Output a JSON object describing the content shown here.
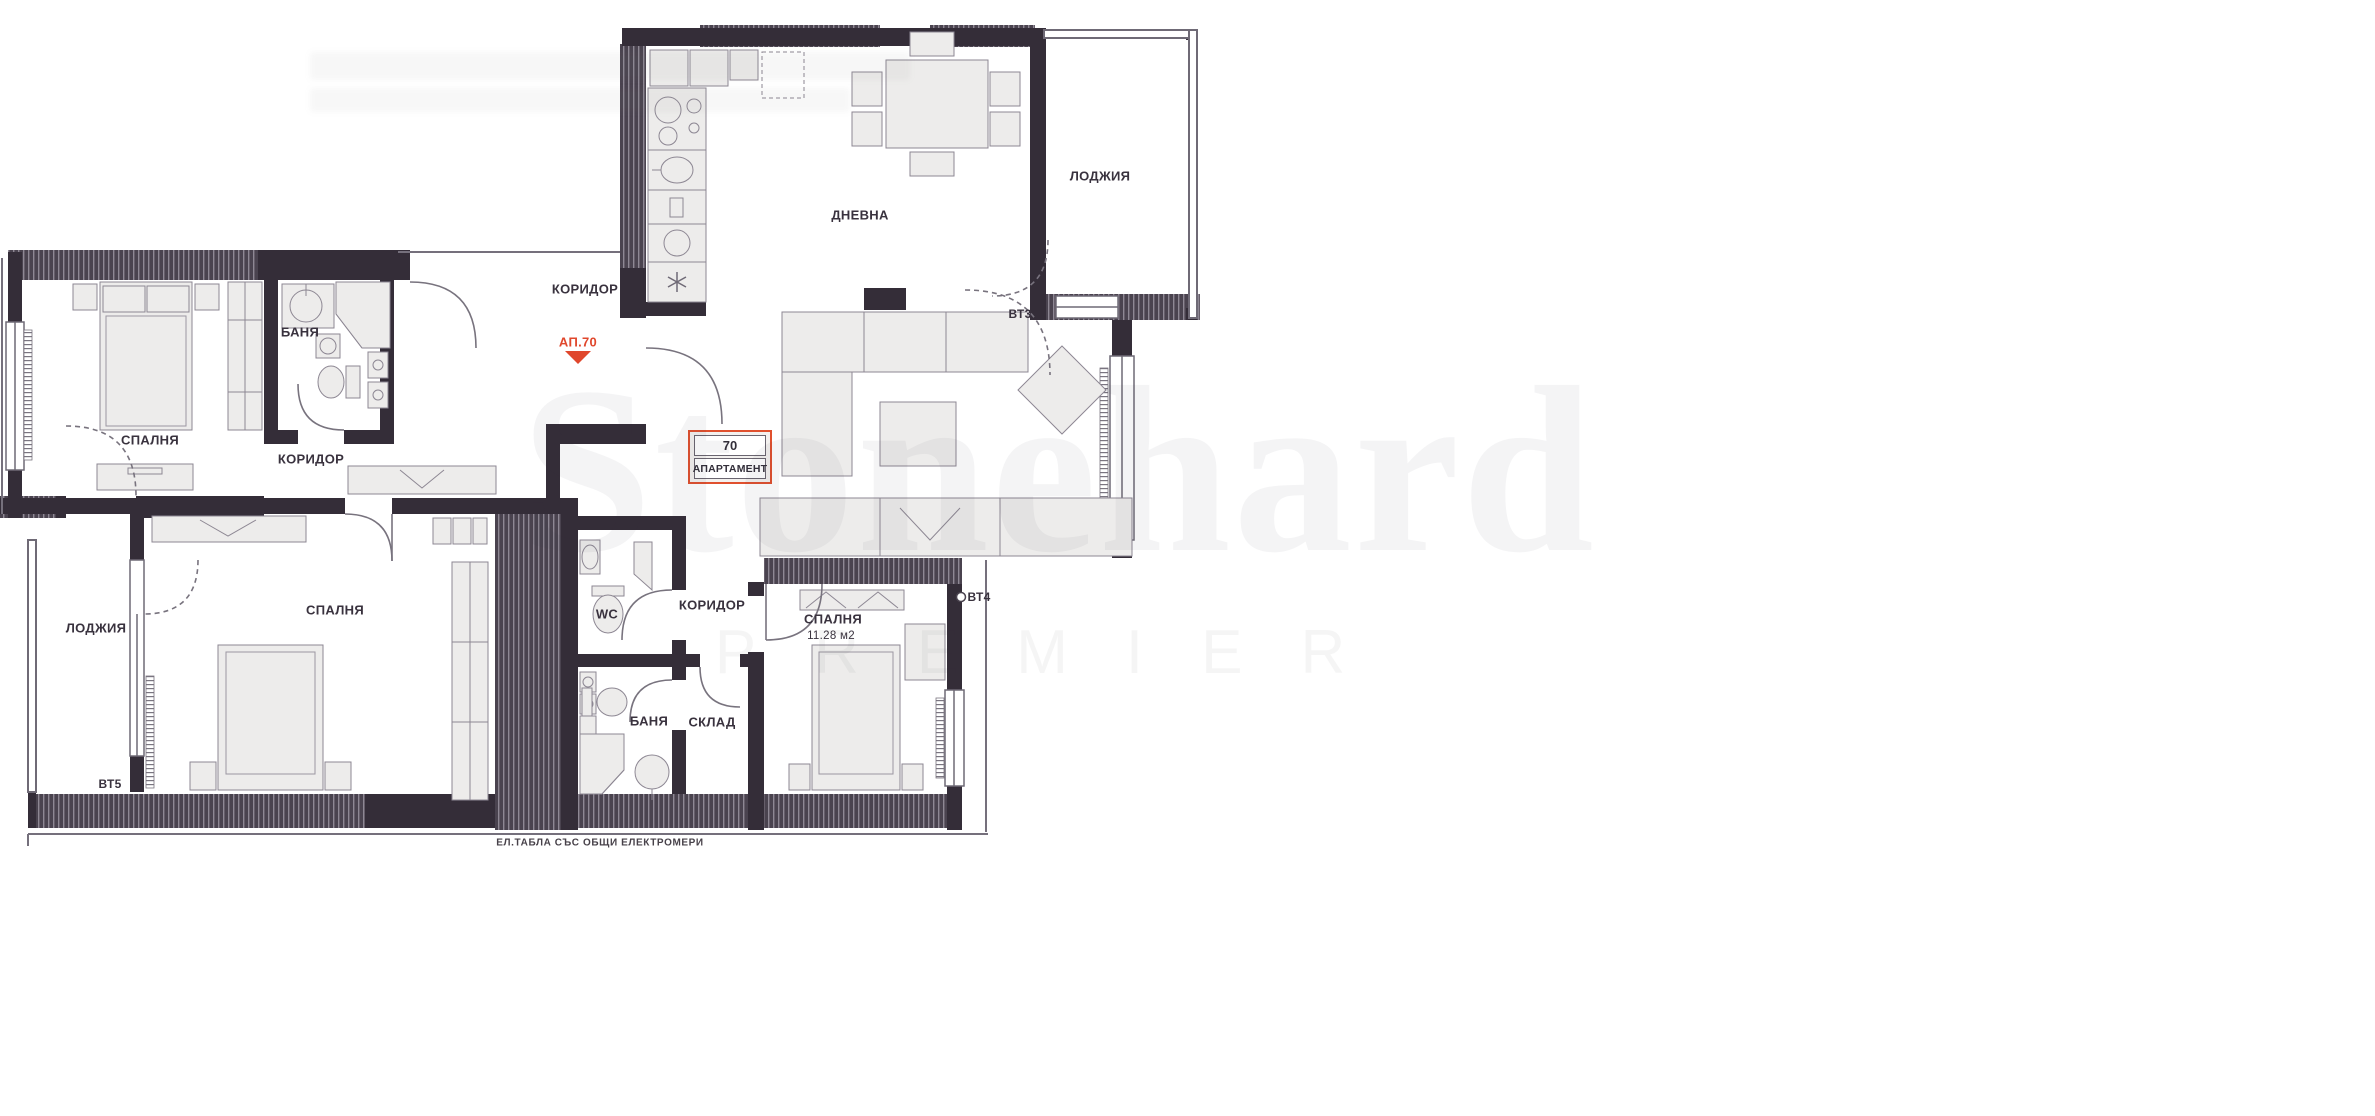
{
  "plan": {
    "labels": {
      "corridor_top": "КОРИДОР",
      "corridor_mid": "КОРИДОР",
      "corridor_bottom": "КОРИДОР",
      "living": "ДНЕВНА",
      "loggia_top": "ЛОДЖИЯ",
      "loggia_left": "ЛОДЖИЯ",
      "bedroom_1": "СПАЛНЯ",
      "bedroom_2": "СПАЛНЯ",
      "bedroom_3": "СПАЛНЯ",
      "bedroom_3_area": "11.28 м2",
      "bath_1": "БАНЯ",
      "bath_2": "БАНЯ",
      "wc": "WC",
      "storage": "СКЛАД",
      "vt3": "ВТ3",
      "vt4": "ВТ4",
      "vt5": "ВТ5",
      "ap_marker": "АП.70",
      "apartment_box": {
        "number": "70",
        "label": "АПАРТАМЕНТ"
      },
      "bottom_note": "ЕЛ.ТАБЛА СЪС ОБЩИ ЕЛЕКТРОМЕРИ"
    },
    "watermark": {
      "brand": "Stonehard",
      "sub": "PREMIER"
    },
    "icons": {
      "fridge": "snowflake-icon",
      "entry_marker": "triangle-down-icon"
    },
    "colors": {
      "wall": "#342d38",
      "hatch_base": "#4a434f",
      "hatch_stripe": "#8e8894",
      "accent": "#e0472c",
      "furniture_fill": "#edeceb",
      "outline": "#8d8793",
      "text": "#39323e"
    }
  }
}
